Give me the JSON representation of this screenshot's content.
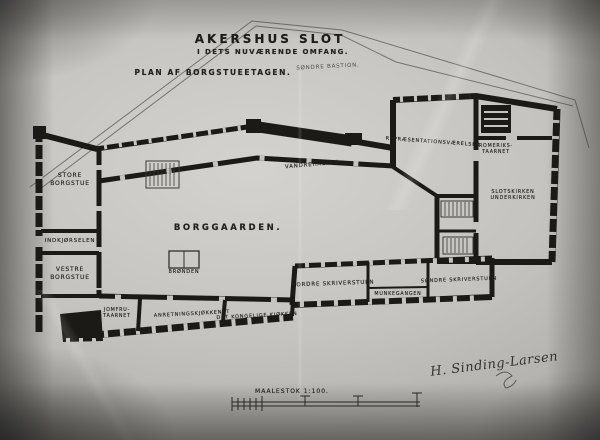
{
  "titles": {
    "main": "AKERSHUS SLOT",
    "subtitle": "I DETS NUVÆRENDE OMFANG.",
    "plan_line": "PLAN AF BORGSTUEETAGEN."
  },
  "outworks": {
    "bastion_label": "SØNDRE BASTION."
  },
  "rooms": {
    "borggaarden": "BORGGAARDEN.",
    "store_borgstue": {
      "line1": "STORE",
      "line2": "BORGSTUE"
    },
    "indkjoersel": "INDKJØRSELEN",
    "vestre_borgstue": {
      "line1": "VESTRE",
      "line2": "BORGSTUE"
    },
    "vandrehallen": "VANDREHALLEN",
    "repraesentation": "REPRÆSENTATIONSVÆRELSER",
    "romeriks_taarnet": {
      "line1": "ROMERIKS-",
      "line2": "TAARNET"
    },
    "slotskirken": {
      "line1": "SLOTSKIRKEN",
      "line2": "UNDERKIRKEN"
    },
    "broenden": "BRØNDEN",
    "nordre_skriverstuen": "NORDRE SKRIVERSTUEN",
    "munkegangen": "MUNKEGANGEN",
    "soendre_skriverstuen": "SØNDRE SKRIVERSTUEN",
    "jomfrutaarnet": {
      "line1": "JOMFRU-",
      "line2": "TAARNET"
    },
    "anretningskjoekkenet": "ANRETNINGSKJØKKENET",
    "det_kongelige_kjoekken": "DET KONGELIGE KJØKKEN"
  },
  "scale": {
    "label": "MAALESTOK 1:100."
  },
  "signature": "H. Sinding-Larsen",
  "colors": {
    "ink": "#1b1a17",
    "paper": "#c4c3bf"
  }
}
